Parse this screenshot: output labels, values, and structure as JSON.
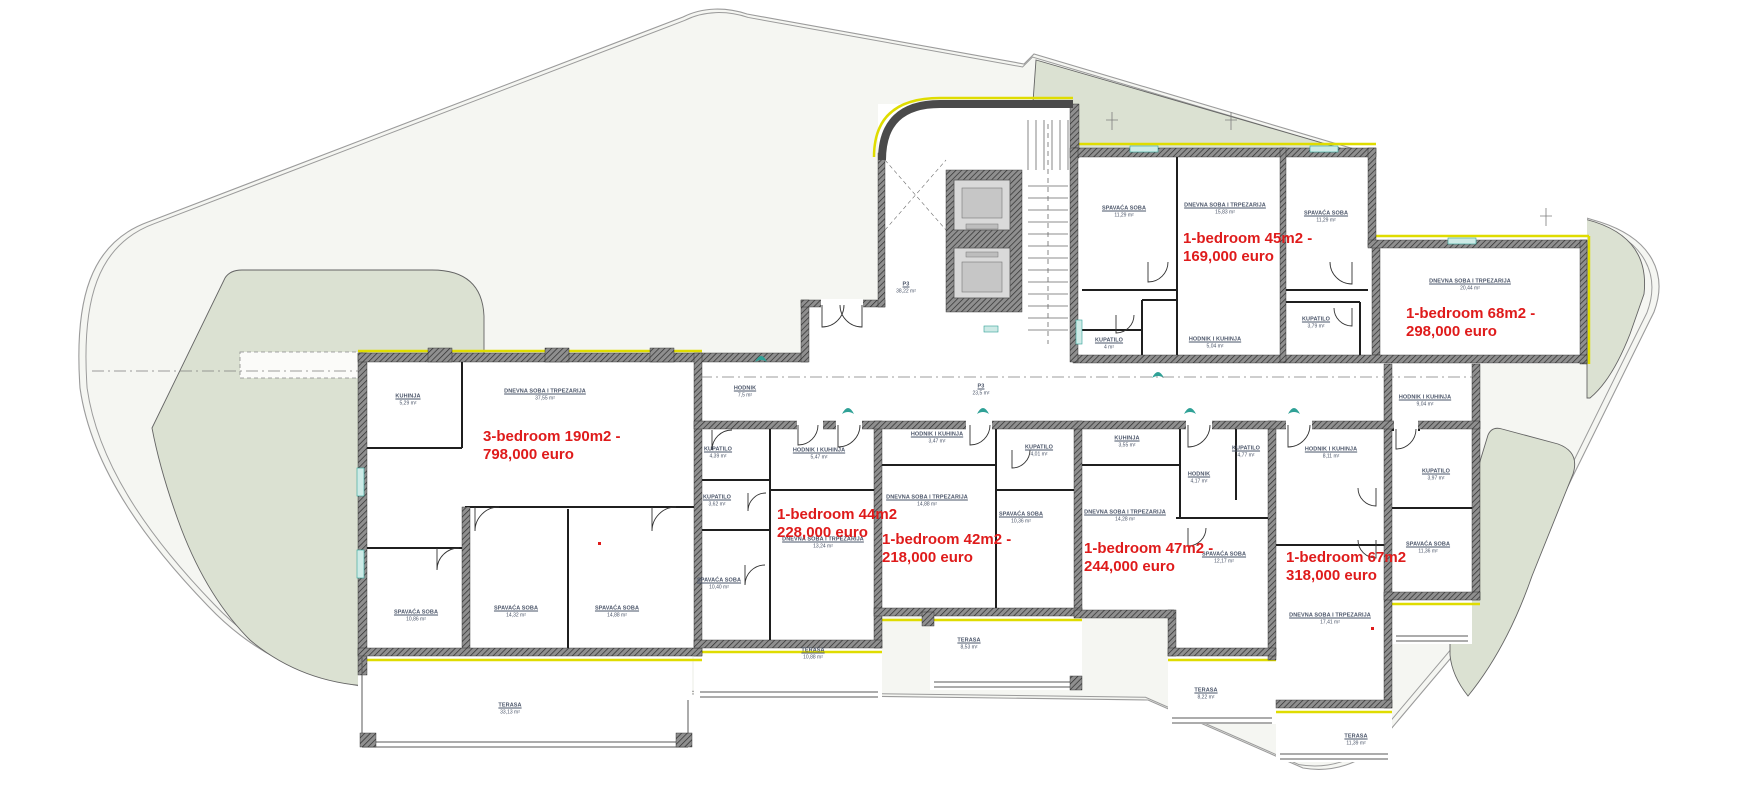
{
  "meta": {
    "type": "apartment-floor-plan",
    "language": "Serbian",
    "annotation_language": "English"
  },
  "colors": {
    "accent_red": "#df1b1b",
    "lawn_green": "#dbe1d2",
    "site_fill": "#f5f6f2",
    "insulation_yellow": "#dfdc00",
    "fixture_teal": "#2fa196",
    "label_ink": "#4a5468"
  },
  "listings": [
    {
      "unit": "3-bedroom",
      "size": "190m2",
      "price": "798,000 euro",
      "lines": [
        "3-bedroom 190m2 -",
        "798,000 euro"
      ],
      "x": 483,
      "y": 428
    },
    {
      "unit": "1-bedroom",
      "size": "45m2",
      "price": "169,000 euro",
      "lines": [
        "1-bedroom 45m2 -",
        "169,000 euro"
      ],
      "x": 1183,
      "y": 230
    },
    {
      "unit": "1-bedroom",
      "size": "68m2",
      "price": "298,000 euro",
      "lines": [
        "1-bedroom 68m2 -",
        "298,000 euro"
      ],
      "x": 1406,
      "y": 305
    },
    {
      "unit": "1-bedroom",
      "size": "44m2",
      "price": "228,000 euro",
      "lines": [
        "1-bedroom 44m2",
        "228,000 euro"
      ],
      "x": 777,
      "y": 506
    },
    {
      "unit": "1-bedroom",
      "size": "42m2",
      "price": "218,000 euro",
      "lines": [
        "1-bedroom 42m2 -",
        "218,000 euro"
      ],
      "x": 882,
      "y": 531
    },
    {
      "unit": "1-bedroom",
      "size": "47m2",
      "price": "244,000 euro",
      "lines": [
        "1-bedroom 47m2 -",
        "244,000 euro"
      ],
      "x": 1084,
      "y": 540
    },
    {
      "unit": "1-bedroom",
      "size": "67m2",
      "price": "318,000 euro",
      "lines": [
        "1-bedroom 67m2",
        "318,000 euro"
      ],
      "x": 1286,
      "y": 549
    }
  ],
  "rooms": [
    {
      "name": "KUHINJA",
      "area": "5,29 m²",
      "x": 408,
      "y": 400
    },
    {
      "name": "DNEVNA SOBA I TRPEZARIJA",
      "area": "37,55 m²",
      "x": 545,
      "y": 395
    },
    {
      "name": "HODNIK",
      "area": "7,5 m²",
      "x": 745,
      "y": 392
    },
    {
      "name": "KUPATILO",
      "area": "4,39 m²",
      "x": 718,
      "y": 453
    },
    {
      "name": "KUPATILO",
      "area": "3,62 m²",
      "x": 717,
      "y": 501
    },
    {
      "name": "SPAVAĆA SOBA",
      "area": "10,40 m²",
      "x": 719,
      "y": 584
    },
    {
      "name": "SPAVAĆA SOBA",
      "area": "10,86 m²",
      "x": 416,
      "y": 616
    },
    {
      "name": "SPAVAĆA SOBA",
      "area": "14,32 m²",
      "x": 516,
      "y": 612
    },
    {
      "name": "SPAVAĆA SOBA",
      "area": "14,88 m²",
      "x": 617,
      "y": 612
    },
    {
      "name": "TERASA",
      "area": "33,13 m²",
      "x": 510,
      "y": 709
    },
    {
      "name": "HODNIK I KUHINJA",
      "area": "5,47 m²",
      "x": 819,
      "y": 454
    },
    {
      "name": "DNEVNA SOBA I TRPEZARIJA",
      "area": "13,24 m²",
      "x": 823,
      "y": 543
    },
    {
      "name": "TERASA",
      "area": "10,88 m²",
      "x": 813,
      "y": 654
    },
    {
      "name": "HODNIK I KUHINJA",
      "area": "3,47 m²",
      "x": 937,
      "y": 438
    },
    {
      "name": "DNEVNA SOBA I TRPEZARIJA",
      "area": "14,88 m²",
      "x": 927,
      "y": 501
    },
    {
      "name": "SPAVAĆA SOBA",
      "area": "10,36 m²",
      "x": 1021,
      "y": 518
    },
    {
      "name": "KUPATILO",
      "area": "4,01 m²",
      "x": 1039,
      "y": 451
    },
    {
      "name": "TERASA",
      "area": "8,53 m²",
      "x": 969,
      "y": 644
    },
    {
      "name": "KUHINJA",
      "area": "3,55 m²",
      "x": 1127,
      "y": 442
    },
    {
      "name": "DNEVNA SOBA I TRPEZARIJA",
      "area": "14,28 m²",
      "x": 1125,
      "y": 516
    },
    {
      "name": "HODNIK",
      "area": "4,17 m²",
      "x": 1199,
      "y": 478
    },
    {
      "name": "KUPATILO",
      "area": "4,77 m²",
      "x": 1246,
      "y": 452
    },
    {
      "name": "SPAVAĆA SOBA",
      "area": "12,17 m²",
      "x": 1224,
      "y": 558
    },
    {
      "name": "TERASA",
      "area": "8,22 m²",
      "x": 1206,
      "y": 694
    },
    {
      "name": "HODNIK I KUHINJA",
      "area": "8,11 m²",
      "x": 1331,
      "y": 453
    },
    {
      "name": "DNEVNA SOBA I TRPEZARIJA",
      "area": "17,41 m²",
      "x": 1330,
      "y": 619
    },
    {
      "name": "TERASA",
      "area": "11,39 m²",
      "x": 1356,
      "y": 740
    },
    {
      "name": "HODNIK I KUHINJA",
      "area": "9,04 m²",
      "x": 1425,
      "y": 401
    },
    {
      "name": "KUPATILO",
      "area": "3,97 m²",
      "x": 1436,
      "y": 475
    },
    {
      "name": "SPAVAĆA SOBA",
      "area": "11,36 m²",
      "x": 1428,
      "y": 548
    },
    {
      "name": "SPAVAĆA SOBA",
      "area": "11,29 m²",
      "x": 1124,
      "y": 212
    },
    {
      "name": "DNEVNA SOBA I TRPEZARIJA",
      "area": "15,83 m²",
      "x": 1225,
      "y": 209
    },
    {
      "name": "KUPATILO",
      "area": "4 m²",
      "x": 1109,
      "y": 344
    },
    {
      "name": "HODNIK I KUHINJA",
      "area": "5,04 m²",
      "x": 1215,
      "y": 343
    },
    {
      "name": "SPAVAĆA SOBA",
      "area": "11,29 m²",
      "x": 1326,
      "y": 217
    },
    {
      "name": "KUPATILO",
      "area": "3,79 m²",
      "x": 1316,
      "y": 323
    },
    {
      "name": "DNEVNA SOBA I TRPEZARIJA",
      "area": "20,44 m²",
      "x": 1470,
      "y": 285
    },
    {
      "name": "P3",
      "area": "38,22 m²",
      "x": 906,
      "y": 288
    },
    {
      "name": "P3",
      "area": "23,5 m²",
      "x": 981,
      "y": 390
    }
  ]
}
